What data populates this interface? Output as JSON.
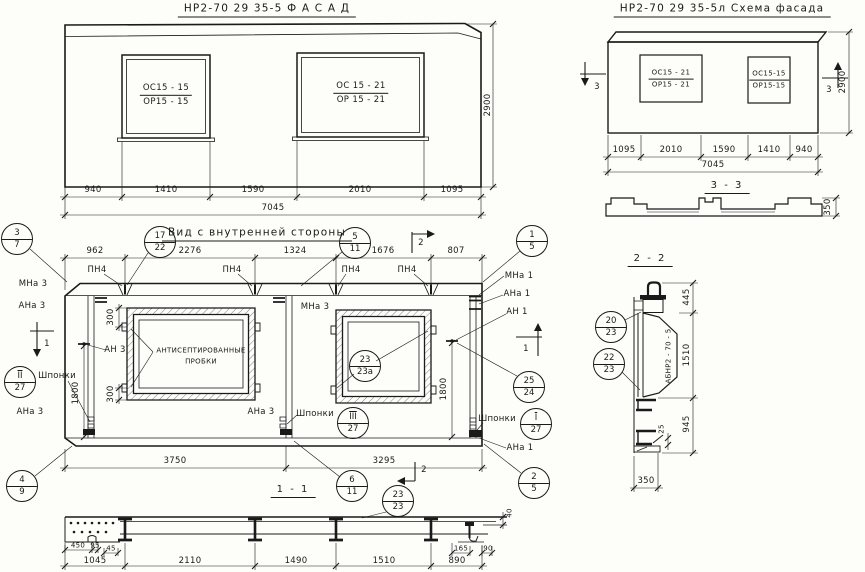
{
  "facade": {
    "title": "НР2-70 29  35-5    Ф А С А Д",
    "win1": {
      "top": "ОС15 - 15",
      "bot": "ОР15 - 15"
    },
    "win2": {
      "top": "ОС 15 - 21",
      "bot": "ОР 15 - 21"
    },
    "dims": {
      "d1": "940",
      "d2": "1410",
      "d3": "1590",
      "d4": "2010",
      "d5": "1095",
      "total": "7045",
      "height": "2900"
    }
  },
  "scheme": {
    "title": "НР2-70 29 35-5л   Схема фасада",
    "win1": {
      "top": "ОС15 - 21",
      "bot": "ОР15 - 21"
    },
    "win2": {
      "top": "ОС15-15",
      "bot": "ОР15-15"
    },
    "dims": {
      "d1": "1095",
      "d2": "2010",
      "d3": "1590",
      "d4": "1410",
      "d5": "940",
      "total": "7045",
      "height": "2900"
    }
  },
  "section33": {
    "title": "3 - 3",
    "thickness": "350"
  },
  "inner": {
    "title": "Вид с внутренней стороны",
    "dims_top": {
      "d1": "962",
      "d2": "2276",
      "d3": "1324",
      "d4": "1676",
      "d5": "807"
    },
    "dims_bottom": {
      "left": "3750",
      "right": "3295"
    },
    "dim_300": "300",
    "dim_1800": "1800",
    "labels": {
      "pn4": "ПН4",
      "mna3": "МНа 3",
      "ana3": "АНа 3",
      "an3": "АН 3",
      "mna1": "МНа 1",
      "ana1": "АНа 1",
      "an1": "АН 1",
      "shponki": "Шпонки"
    },
    "plug_note": {
      "line1": "АНТИСЕПТИРОВАННЫЕ",
      "line2": "ПРОБКИ"
    }
  },
  "section11": {
    "title": "1 - 1",
    "dims": {
      "d1": "1045",
      "d2": "2110",
      "d3": "1490",
      "d4": "1510",
      "d5": "890",
      "s450": "450",
      "s95": "95",
      "s45": "45",
      "s165": "165",
      "s90": "90",
      "s40": "40"
    }
  },
  "section22": {
    "title": "2 - 2",
    "stamp": "АБНР2 - 70 - 5",
    "dims": {
      "d445": "445",
      "d1510": "1510",
      "d945": "945",
      "d25": "25",
      "d350": "350"
    }
  },
  "markers": {
    "m1": "1",
    "m2": "2",
    "m3": "3"
  },
  "callouts": {
    "c3_7": {
      "t": "3",
      "b": "7"
    },
    "c17_22": {
      "t": "17",
      "b": "22"
    },
    "c5_11": {
      "t": "5",
      "b": "11"
    },
    "c1_5": {
      "t": "1",
      "b": "5"
    },
    "c4_9": {
      "t": "4",
      "b": "9"
    },
    "c6_11": {
      "t": "6",
      "b": "11"
    },
    "c2_5": {
      "t": "2",
      "b": "5"
    },
    "c23_23a": {
      "t": "23",
      "b": "23а"
    },
    "c25_24": {
      "t": "25",
      "b": "24"
    },
    "cII_27": {
      "t": "II",
      "b": "27"
    },
    "cIII_27": {
      "t": "III",
      "b": "27"
    },
    "cI_27": {
      "t": "I",
      "b": "27"
    },
    "c23_23": {
      "t": "23",
      "b": "23"
    },
    "c20_23": {
      "t": "20",
      "b": "23"
    },
    "c22_23": {
      "t": "22",
      "b": "23"
    }
  }
}
